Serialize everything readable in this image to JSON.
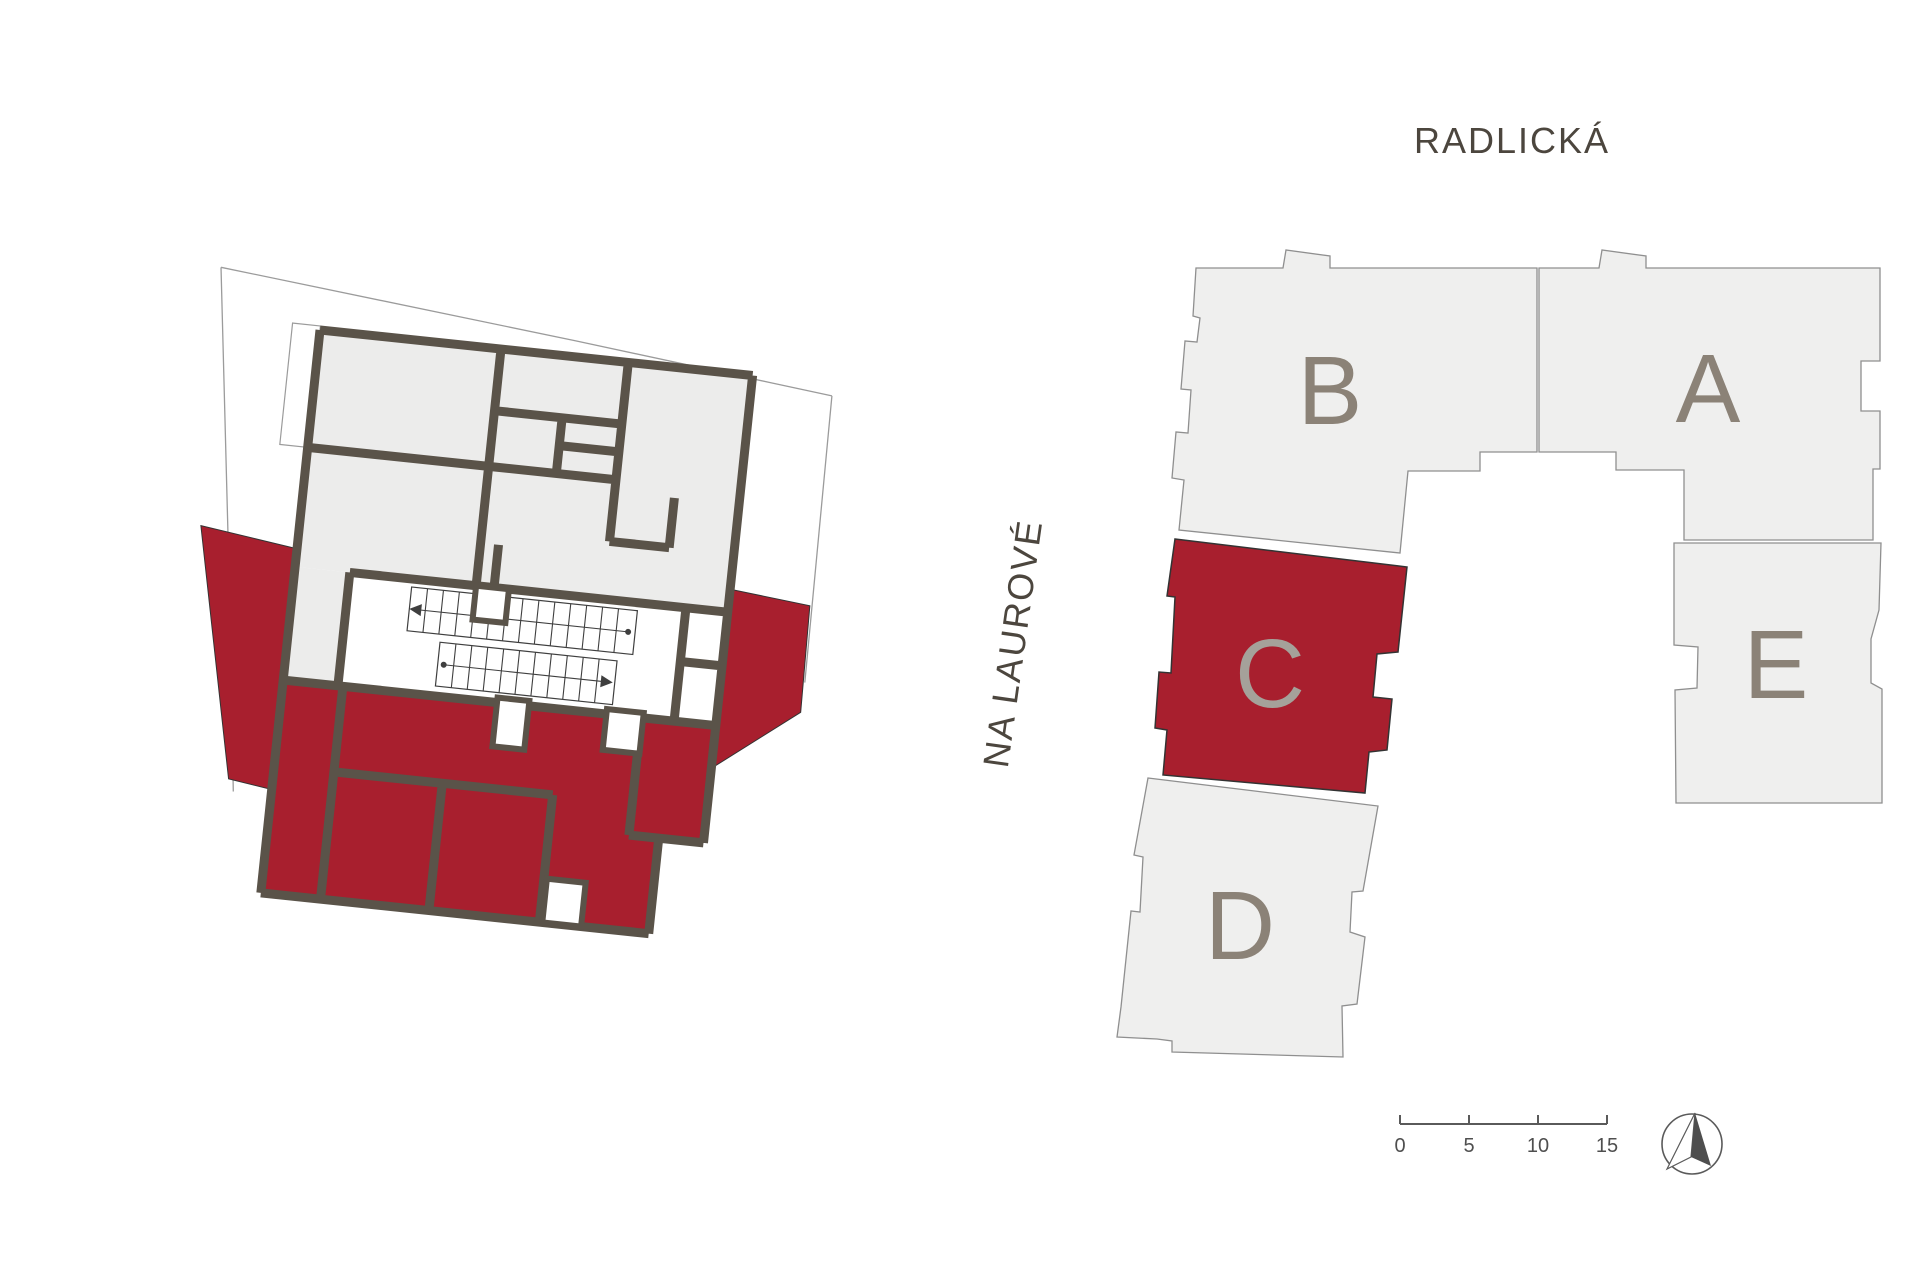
{
  "site_plan": {
    "street_top": "RADLICKÁ",
    "street_left": "NA LAUROVÉ",
    "highlighted_building": "C",
    "buildings": [
      {
        "label": "B",
        "highlighted": false
      },
      {
        "label": "A",
        "highlighted": false
      },
      {
        "label": "C",
        "highlighted": true
      },
      {
        "label": "E",
        "highlighted": false
      },
      {
        "label": "D",
        "highlighted": false
      }
    ]
  },
  "floor_plan": {
    "description": "unit floor plan with highlighted apartment",
    "highlighted_unit": "C"
  },
  "scale_bar": {
    "ticks": [
      "0",
      "5",
      "10",
      "15"
    ]
  },
  "colors": {
    "highlight": "#a81f2e",
    "block_fill": "#efefee",
    "block_outline": "#8f8f8f",
    "letter": "#8b8277",
    "letter_on_red": "#a5a19a",
    "street_text": "#4c463e",
    "wall": "#5a5349",
    "room": "#ececeb"
  }
}
